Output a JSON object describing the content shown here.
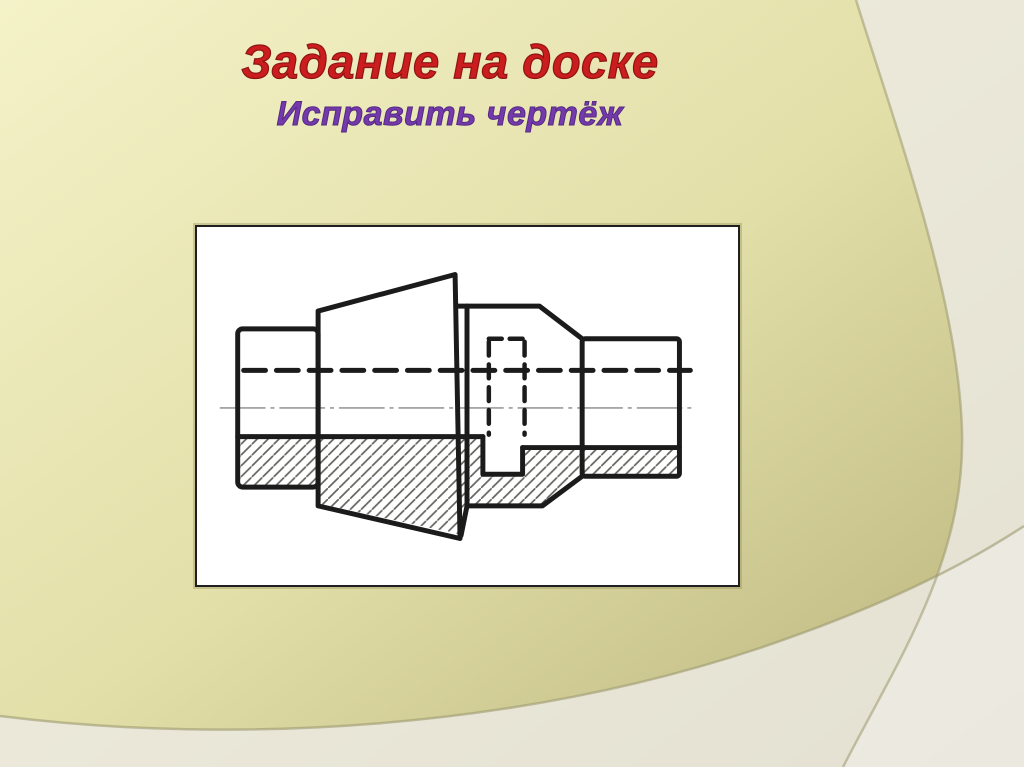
{
  "slide": {
    "title": "Задание на доске",
    "subtitle": "Исправить чертёж"
  },
  "figure": {
    "name": "pipe-union-half-section-drawing",
    "description": "Hand-drawn orthographic view of a pipe union fitting; lower half hatched as a section, horizontal axis drawn as a thick dashed line above a thin center line, hidden slot shown with dashed lines"
  },
  "colors": {
    "title": "#cb1d1d",
    "title_outline": "#8d1414",
    "subtitle": "#7439ab",
    "subtitle_outline": "#542a83",
    "background_gradient_start": "#f4f2c8",
    "background_gradient_mid": "#e3dfa9",
    "background_gradient_end": "#b7b27a",
    "overlay_panel": "#eceae2",
    "curve_line": "#9d996f",
    "frame_background": "#ffffff",
    "frame_border": "#1f1f1f",
    "ink": "#1b1b1b",
    "hatch": "#64645f",
    "centerline": "#9b9b97"
  }
}
